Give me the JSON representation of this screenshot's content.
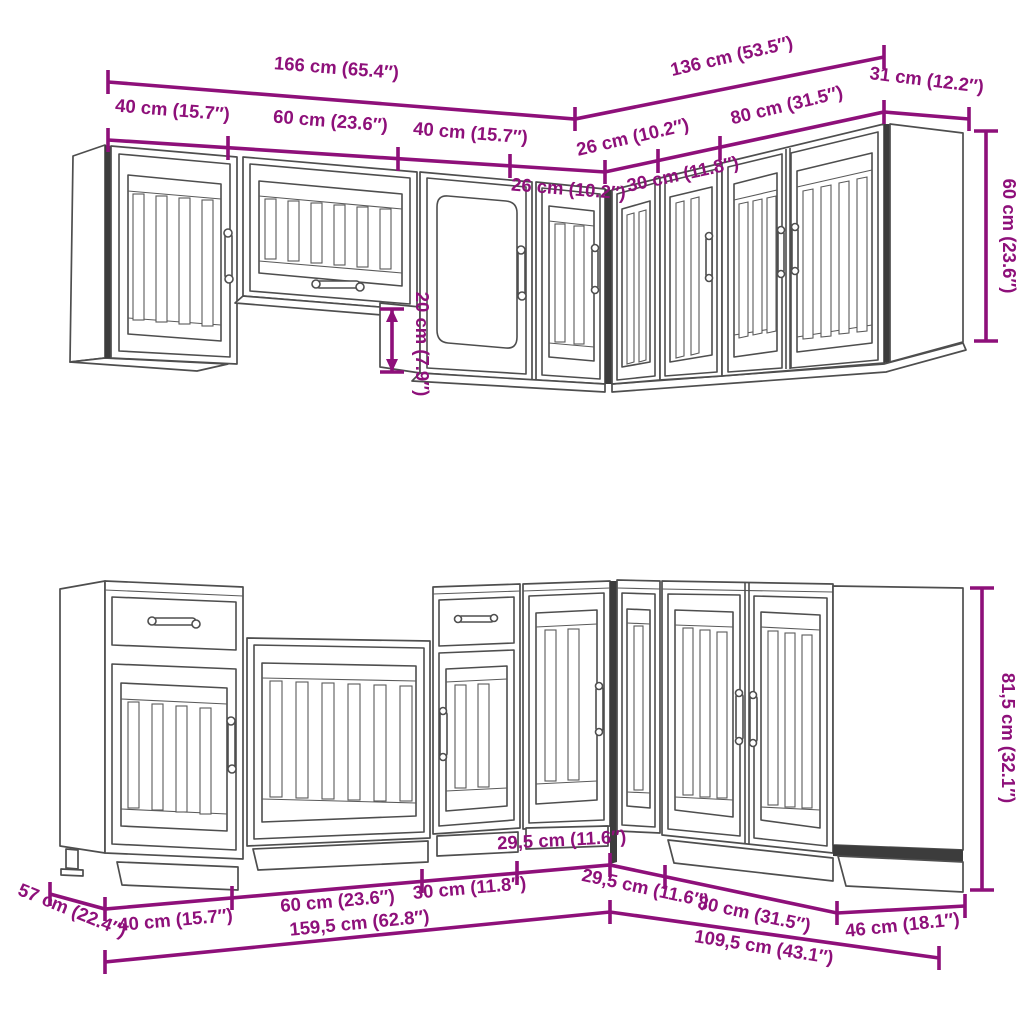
{
  "title": "Kitchen cabinet set dimensional line diagram",
  "colors": {
    "background": "#ffffff",
    "dimension": "#8e107a",
    "line_art": "#4e4e4e",
    "dark_accent": "#3c3c3c"
  },
  "wall_units": {
    "dims": {
      "run_left_total": "166 cm (65.4″)",
      "run_right_total": "136 cm (53.5″)",
      "end_unit_width": "31 cm (12.2″)",
      "seg_left_1": "40 cm (15.7″)",
      "seg_left_2": "60 cm (23.6″)",
      "seg_left_3": "40 cm (15.7″)",
      "seg_left_corner": "26 cm (10.2″)",
      "seg_right_corner": "26 cm (10.2″)",
      "seg_right_1": "30 cm (11.8″)",
      "seg_right_2": "80 cm (31.5″)",
      "unit_height": "60 cm (23.6″)",
      "hood_unit_offset": "20 cm (7.9″)"
    }
  },
  "base_units": {
    "dims": {
      "depth": "57 cm (22.4″)",
      "seg_left_1": "40 cm (15.7″)",
      "seg_left_2": "60 cm (23.6″)",
      "seg_left_3": "30 cm (11.8″)",
      "seg_left_corner": "29,5 cm (11.6″)",
      "seg_right_corner": "29,5 cm (11.6″)",
      "seg_right_1": "80 cm (31.5″)",
      "end_unit_width": "46 cm (18.1″)",
      "run_left_total": "159,5 cm (62.8″)",
      "run_right_total": "109,5 cm (43.1″)",
      "unit_height": "81,5 cm (32.1″)"
    }
  }
}
